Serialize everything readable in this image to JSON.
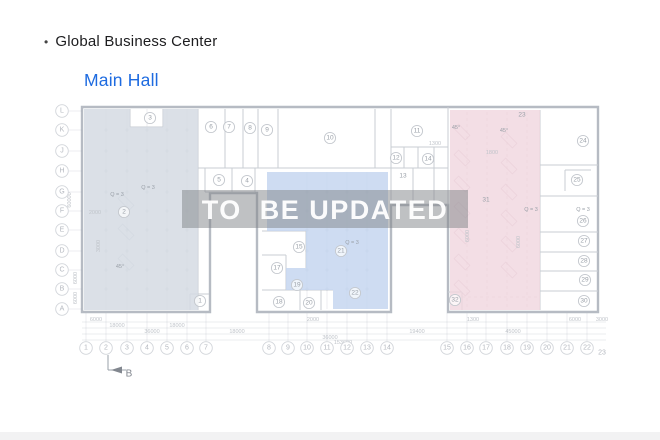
{
  "header": {
    "bullet": "•",
    "building": "Global Business Center",
    "hall": "Main Hall"
  },
  "watermark": {
    "text": "TO  BE UPDATED",
    "band": [
      182,
      190,
      286,
      38
    ]
  },
  "colors": {
    "hall_title": "#1e6be0",
    "wall": "#b6bbc3",
    "line": "#c9cdd3",
    "faint": "rgba(150,158,170,0.25)",
    "grid": "#d2d5da",
    "grid_text": "#b4b8bf",
    "label": "#9aa0a8",
    "dim": "#c0c4ca",
    "zone_left": "rgba(213,219,227,0.85)",
    "zone_mid": "rgba(198,214,240,0.85)",
    "zone_right": "rgba(240,214,223,0.8)",
    "stall_pink": "rgba(176,130,148,0.45)",
    "stall_blue": "rgba(130,145,165,0.4)",
    "dash_pink": "rgba(175,135,150,0.35)",
    "band": "rgba(128,131,136,0.5)",
    "band_text": "rgba(255,255,255,0.95)"
  },
  "floorplan": {
    "outline": [
      [
        82,
        107
      ],
      [
        598,
        107
      ],
      [
        598,
        312
      ],
      [
        448,
        312
      ],
      [
        448,
        205
      ],
      [
        391,
        205
      ],
      [
        391,
        312
      ],
      [
        257,
        312
      ],
      [
        257,
        193
      ],
      [
        210,
        193
      ],
      [
        210,
        312
      ],
      [
        82,
        312
      ]
    ],
    "zones": [
      {
        "name": "zone-left-hall",
        "points": [
          [
            84,
            109
          ],
          [
            130,
            109
          ],
          [
            130,
            127
          ],
          [
            163,
            127
          ],
          [
            163,
            109
          ],
          [
            198,
            109
          ],
          [
            198,
            310
          ],
          [
            84,
            310
          ]
        ],
        "fill": "zone_left"
      },
      {
        "name": "zone-middle-hall",
        "points": [
          [
            267,
            172
          ],
          [
            388,
            172
          ],
          [
            388,
            309
          ],
          [
            333,
            309
          ],
          [
            333,
            290
          ],
          [
            286,
            290
          ],
          [
            286,
            268
          ],
          [
            306,
            268
          ],
          [
            306,
            231
          ],
          [
            267,
            231
          ]
        ],
        "fill": "zone_mid"
      },
      {
        "name": "zone-right-hall",
        "points": [
          [
            450,
            110
          ],
          [
            540,
            110
          ],
          [
            540,
            310
          ],
          [
            450,
            310
          ]
        ],
        "fill": "zone_right"
      }
    ],
    "walls": [
      [
        198,
        109,
        198,
        310
      ],
      [
        130,
        109,
        130,
        127
      ],
      [
        130,
        127,
        163,
        127
      ],
      [
        163,
        109,
        163,
        127
      ],
      [
        190,
        294,
        209,
        294
      ],
      [
        190,
        294,
        190,
        310
      ],
      [
        198,
        168,
        448,
        168
      ],
      [
        225,
        109,
        225,
        168
      ],
      [
        243,
        109,
        243,
        168
      ],
      [
        258,
        109,
        258,
        168
      ],
      [
        278,
        109,
        278,
        168
      ],
      [
        375,
        109,
        375,
        168
      ],
      [
        391,
        109,
        391,
        205
      ],
      [
        391,
        147,
        448,
        147
      ],
      [
        404,
        147,
        404,
        168
      ],
      [
        418,
        147,
        418,
        168
      ],
      [
        434,
        147,
        434,
        168
      ],
      [
        413,
        168,
        413,
        205
      ],
      [
        434,
        168,
        434,
        205
      ],
      [
        448,
        107,
        448,
        205
      ],
      [
        205,
        168,
        205,
        192
      ],
      [
        232,
        168,
        232,
        192
      ],
      [
        255,
        168,
        255,
        192
      ],
      [
        205,
        192,
        255,
        192
      ],
      [
        262,
        231,
        306,
        231
      ],
      [
        306,
        231,
        306,
        268
      ],
      [
        262,
        255,
        286,
        255
      ],
      [
        286,
        255,
        286,
        290
      ],
      [
        262,
        290,
        333,
        290
      ],
      [
        300,
        290,
        300,
        310
      ],
      [
        321,
        290,
        321,
        310
      ],
      [
        540,
        110,
        540,
        310
      ],
      [
        540,
        165,
        598,
        165
      ],
      [
        540,
        196,
        598,
        196
      ],
      [
        540,
        232,
        598,
        232
      ],
      [
        540,
        252,
        598,
        252
      ],
      [
        540,
        271,
        598,
        271
      ],
      [
        540,
        291,
        598,
        291
      ],
      [
        565,
        170,
        565,
        191
      ],
      [
        565,
        170,
        591,
        170
      ],
      [
        448,
        292,
        462,
        292
      ],
      [
        462,
        292,
        462,
        310
      ]
    ],
    "faint": [
      [
        106,
        109,
        106,
        310
      ],
      [
        127,
        109,
        127,
        310
      ],
      [
        147,
        109,
        147,
        310
      ],
      [
        167,
        109,
        167,
        310
      ],
      [
        187,
        109,
        187,
        310
      ],
      [
        307,
        172,
        307,
        309
      ],
      [
        327,
        172,
        327,
        309
      ],
      [
        347,
        172,
        347,
        309
      ],
      [
        367,
        172,
        367,
        309
      ],
      [
        82,
        322,
        606,
        322
      ],
      [
        82,
        328,
        606,
        328
      ],
      [
        82,
        334,
        606,
        334
      ],
      [
        82,
        340,
        606,
        340
      ]
    ],
    "dashed": [
      [
        467,
        112,
        467,
        308
      ],
      [
        487,
        112,
        487,
        308
      ],
      [
        507,
        112,
        507,
        308
      ],
      [
        527,
        112,
        527,
        308
      ],
      [
        450,
        297,
        540,
        297
      ]
    ],
    "stalls": [
      {
        "x": 462,
        "y0": 132,
        "y1": 288,
        "step": 26,
        "color": "stall_pink"
      },
      {
        "x": 509,
        "y0": 140,
        "y1": 292,
        "step": 26,
        "color": "stall_pink"
      },
      {
        "x": 126,
        "y0": 202,
        "y1": 290,
        "step": 30,
        "color": "stall_blue"
      }
    ],
    "plusmarks": [
      {
        "xs": [
          106,
          127,
          147,
          167,
          187
        ],
        "ys": [
          130,
          151,
          171,
          192,
          211,
          230,
          251,
          270,
          289
        ]
      },
      {
        "xs": [
          307,
          327,
          347,
          367
        ],
        "ys": [
          192,
          211,
          230,
          251,
          270,
          289
        ]
      }
    ],
    "rooms_circled": [
      {
        "n": "1",
        "x": 200,
        "y": 301
      },
      {
        "n": "2",
        "x": 124,
        "y": 212
      },
      {
        "n": "3",
        "x": 150,
        "y": 118
      },
      {
        "n": "4",
        "x": 247,
        "y": 181
      },
      {
        "n": "5",
        "x": 219,
        "y": 180
      },
      {
        "n": "6",
        "x": 211,
        "y": 127
      },
      {
        "n": "7",
        "x": 229,
        "y": 127
      },
      {
        "n": "8",
        "x": 250,
        "y": 128
      },
      {
        "n": "9",
        "x": 267,
        "y": 130
      },
      {
        "n": "10",
        "x": 330,
        "y": 138
      },
      {
        "n": "11",
        "x": 417,
        "y": 131
      },
      {
        "n": "12",
        "x": 396,
        "y": 158
      },
      {
        "n": "14",
        "x": 428,
        "y": 159
      },
      {
        "n": "15",
        "x": 299,
        "y": 247
      },
      {
        "n": "17",
        "x": 277,
        "y": 268
      },
      {
        "n": "18",
        "x": 279,
        "y": 302
      },
      {
        "n": "19",
        "x": 297,
        "y": 285
      },
      {
        "n": "20",
        "x": 309,
        "y": 303
      },
      {
        "n": "21",
        "x": 341,
        "y": 251
      },
      {
        "n": "22",
        "x": 355,
        "y": 293
      },
      {
        "n": "24",
        "x": 583,
        "y": 141
      },
      {
        "n": "25",
        "x": 577,
        "y": 180
      },
      {
        "n": "26",
        "x": 583,
        "y": 221
      },
      {
        "n": "27",
        "x": 584,
        "y": 241
      },
      {
        "n": "28",
        "x": 584,
        "y": 261
      },
      {
        "n": "29",
        "x": 585,
        "y": 280
      },
      {
        "n": "30",
        "x": 584,
        "y": 301
      },
      {
        "n": "32",
        "x": 455,
        "y": 300
      }
    ],
    "rooms_plain": [
      {
        "n": "13",
        "x": 403,
        "y": 176
      },
      {
        "n": "23",
        "x": 522,
        "y": 115
      },
      {
        "n": "31",
        "x": 486,
        "y": 200
      }
    ],
    "annotations": [
      {
        "t": "Q = 3",
        "x": 148,
        "y": 188
      },
      {
        "t": "Q = 3",
        "x": 117,
        "y": 195
      },
      {
        "t": "Q = 3",
        "x": 352,
        "y": 243
      },
      {
        "t": "Q = 3",
        "x": 531,
        "y": 210
      },
      {
        "t": "Q = 3",
        "x": 583,
        "y": 210
      },
      {
        "t": "45°",
        "x": 456,
        "y": 128
      },
      {
        "t": "45°",
        "x": 504,
        "y": 131
      },
      {
        "t": "45°",
        "x": 120,
        "y": 267
      }
    ],
    "dims_inside": [
      {
        "t": "2000",
        "x": 95,
        "y": 213
      },
      {
        "t": "1300",
        "x": 435,
        "y": 144
      },
      {
        "t": "1800",
        "x": 492,
        "y": 153
      },
      {
        "t": "6000",
        "x": 468,
        "y": 236,
        "rot": -90
      },
      {
        "t": "6000",
        "x": 519,
        "y": 242,
        "rot": -90
      },
      {
        "t": "3000",
        "x": 99,
        "y": 246,
        "rot": -90
      }
    ],
    "dims_bottom": [
      {
        "t": "6000",
        "x": 96,
        "y": 320
      },
      {
        "t": "2000",
        "x": 313,
        "y": 320
      },
      {
        "t": "1300",
        "x": 473,
        "y": 320
      },
      {
        "t": "6000",
        "x": 575,
        "y": 320
      },
      {
        "t": "3000",
        "x": 602,
        "y": 320
      },
      {
        "t": "18000",
        "x": 117,
        "y": 326
      },
      {
        "t": "18000",
        "x": 177,
        "y": 326
      },
      {
        "t": "36000",
        "x": 152,
        "y": 332
      },
      {
        "t": "18000",
        "x": 237,
        "y": 332
      },
      {
        "t": "19400",
        "x": 417,
        "y": 332
      },
      {
        "t": "45000",
        "x": 513,
        "y": 332
      },
      {
        "t": "36000",
        "x": 330,
        "y": 338
      },
      {
        "t": "153600",
        "x": 343,
        "y": 343
      }
    ],
    "dims_left": [
      {
        "t": "60000",
        "x": 70,
        "y": 200,
        "rot": -90
      },
      {
        "t": "6000",
        "x": 76,
        "y": 278,
        "rot": -90
      },
      {
        "t": "6000",
        "x": 76,
        "y": 298,
        "rot": -90
      }
    ],
    "grid_rows": [
      {
        "label": "L",
        "y": 111
      },
      {
        "label": "K",
        "y": 130
      },
      {
        "label": "J",
        "y": 151
      },
      {
        "label": "H",
        "y": 171
      },
      {
        "label": "G",
        "y": 192
      },
      {
        "label": "F",
        "y": 211
      },
      {
        "label": "E",
        "y": 230
      },
      {
        "label": "D",
        "y": 251
      },
      {
        "label": "C",
        "y": 270
      },
      {
        "label": "B",
        "y": 289
      },
      {
        "label": "A",
        "y": 309
      }
    ],
    "grid_cols": [
      {
        "label": "1",
        "x": 86
      },
      {
        "label": "2",
        "x": 106
      },
      {
        "label": "3",
        "x": 127
      },
      {
        "label": "4",
        "x": 147
      },
      {
        "label": "5",
        "x": 167
      },
      {
        "label": "6",
        "x": 187
      },
      {
        "label": "7",
        "x": 206
      },
      {
        "label": "8",
        "x": 269
      },
      {
        "label": "9",
        "x": 288
      },
      {
        "label": "10",
        "x": 307
      },
      {
        "label": "11",
        "x": 327
      },
      {
        "label": "12",
        "x": 347
      },
      {
        "label": "13",
        "x": 367
      },
      {
        "label": "14",
        "x": 387
      },
      {
        "label": "15",
        "x": 447
      },
      {
        "label": "16",
        "x": 467
      },
      {
        "label": "17",
        "x": 486
      },
      {
        "label": "18",
        "x": 507
      },
      {
        "label": "19",
        "x": 527
      },
      {
        "label": "20",
        "x": 547
      },
      {
        "label": "21",
        "x": 567
      },
      {
        "label": "22",
        "x": 587
      }
    ],
    "grid_cols_y": 348,
    "grid_col_plain": {
      "label": "23",
      "x": 602,
      "y": 353
    },
    "section_marker": {
      "label": "B",
      "vline": [
        108,
        355,
        108,
        370
      ],
      "hline": [
        108,
        370,
        126,
        370
      ],
      "arrow": [
        [
          122,
          366.5
        ],
        [
          122,
          373.5
        ],
        [
          111,
          370
        ]
      ],
      "lx": 129,
      "ly": 374
    }
  }
}
